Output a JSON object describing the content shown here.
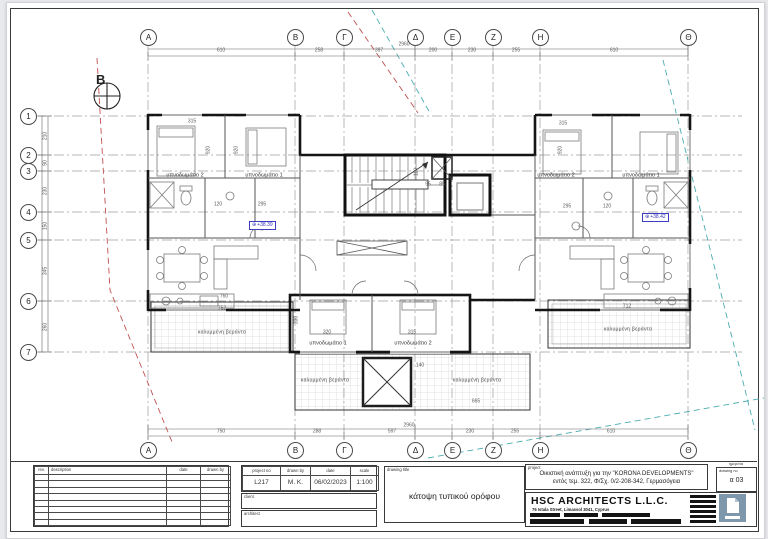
{
  "north_label": "B",
  "grid": {
    "top_letters": [
      "A",
      "B",
      "Γ",
      "Δ",
      "E",
      "Z",
      "H",
      "Θ"
    ],
    "bottom_letters": [
      "A",
      "B",
      "Γ",
      "Δ",
      "E",
      "Z",
      "H",
      "Θ"
    ],
    "left_numbers": [
      "1",
      "2",
      "3",
      "4",
      "5",
      "6",
      "7"
    ]
  },
  "plan": {
    "levels": {
      "icon": "⊕",
      "left": "+38.39",
      "right": "+38.42"
    },
    "annotations": [
      {
        "t": "610",
        "x": 221,
        "y": 51
      },
      {
        "t": "258",
        "x": 319,
        "y": 51
      },
      {
        "t": "397",
        "x": 379,
        "y": 51
      },
      {
        "t": "200",
        "x": 433,
        "y": 51
      },
      {
        "t": "230",
        "x": 472,
        "y": 51
      },
      {
        "t": "255",
        "x": 516,
        "y": 51
      },
      {
        "t": "610",
        "x": 614,
        "y": 51
      },
      {
        "t": "2960",
        "x": 404,
        "y": 45
      },
      {
        "t": "750",
        "x": 221,
        "y": 432
      },
      {
        "t": "288",
        "x": 317,
        "y": 432
      },
      {
        "t": "597",
        "x": 392,
        "y": 432
      },
      {
        "t": "230",
        "x": 470,
        "y": 432
      },
      {
        "t": "255",
        "x": 515,
        "y": 432
      },
      {
        "t": "610",
        "x": 611,
        "y": 432
      },
      {
        "t": "2960",
        "x": 409,
        "y": 426
      },
      {
        "t": "210",
        "x": 46,
        "y": 136,
        "r": -90
      },
      {
        "t": "90",
        "x": 46,
        "y": 163,
        "r": -90
      },
      {
        "t": "230",
        "x": 46,
        "y": 191,
        "r": -90
      },
      {
        "t": "150",
        "x": 46,
        "y": 226,
        "r": -90
      },
      {
        "t": "345",
        "x": 46,
        "y": 271,
        "r": -90
      },
      {
        "t": "260",
        "x": 46,
        "y": 327,
        "r": -90
      },
      {
        "t": "315",
        "x": 192,
        "y": 122
      },
      {
        "t": "315",
        "x": 563,
        "y": 124
      },
      {
        "t": "920",
        "x": 209,
        "y": 150,
        "r": -90
      },
      {
        "t": "920",
        "x": 237,
        "y": 150,
        "r": -90
      },
      {
        "t": "920",
        "x": 561,
        "y": 150,
        "r": -90
      },
      {
        "t": "120",
        "x": 218,
        "y": 205
      },
      {
        "t": "295",
        "x": 262,
        "y": 205
      },
      {
        "t": "295",
        "x": 567,
        "y": 207
      },
      {
        "t": "120",
        "x": 607,
        "y": 207
      },
      {
        "t": "110",
        "x": 417,
        "y": 172,
        "r": -90
      },
      {
        "t": "95",
        "x": 428,
        "y": 185
      },
      {
        "t": "85",
        "x": 442,
        "y": 185
      },
      {
        "t": "760",
        "x": 224,
        "y": 297
      },
      {
        "t": "752",
        "x": 222,
        "y": 309
      },
      {
        "t": "712",
        "x": 627,
        "y": 307
      },
      {
        "t": "320",
        "x": 327,
        "y": 333
      },
      {
        "t": "315",
        "x": 412,
        "y": 333
      },
      {
        "t": "330",
        "x": 297,
        "y": 320,
        "r": -90
      },
      {
        "t": "140",
        "x": 420,
        "y": 366
      },
      {
        "t": "665",
        "x": 476,
        "y": 402
      },
      {
        "t": "υπνοδωμάτιο 2",
        "x": 185,
        "y": 176,
        "c": "room"
      },
      {
        "t": "υπνοδωμάτιο 1",
        "x": 264,
        "y": 176,
        "c": "room"
      },
      {
        "t": "υπνοδωμάτιο 2",
        "x": 556,
        "y": 176,
        "c": "room"
      },
      {
        "t": "υπνοδωμάτιο 1",
        "x": 641,
        "y": 176,
        "c": "room"
      },
      {
        "t": "υπνοδωμάτιο 1",
        "x": 328,
        "y": 344,
        "c": "room"
      },
      {
        "t": "υπνοδωμάτιο 2",
        "x": 413,
        "y": 344,
        "c": "room"
      },
      {
        "t": "καλυμμένη βεράντα",
        "x": 222,
        "y": 333,
        "c": "ver"
      },
      {
        "t": "καλυμμένη βεράντα",
        "x": 628,
        "y": 330,
        "c": "ver"
      },
      {
        "t": "καλυμμένη βεράντα",
        "x": 325,
        "y": 381,
        "c": "ver"
      },
      {
        "t": "καλυμμένη βεράντα",
        "x": 477,
        "y": 381,
        "c": "ver"
      }
    ]
  },
  "titleblock": {
    "revision_table": {
      "headers": [
        "rev.",
        "description",
        "date",
        "drawn by"
      ]
    },
    "project_info": {
      "headers": [
        "project no",
        "drawn by",
        "date",
        "scale"
      ],
      "values": [
        "L217",
        "M. K.",
        "06/02/2023",
        "1:100"
      ]
    },
    "client_label": "client",
    "architect_label": "architect",
    "drawing_title_label": "drawing title",
    "drawing_title": "κάτοψη τυπικού ορόφου",
    "project_label": "project",
    "project_line1": "Οικιστική ανάπτυξη για την \"KORONA DEVELOPMENTS\"",
    "project_line2": "εντός τεμ. 322, Φ/Σχ. 0/2-208-342, Γερμασόγεια",
    "corner_label": "ημερ/νία",
    "drawing_no_label": "drawing no",
    "drawing_no": "α 03",
    "firm_name": "HSC ARCHITECTS L.L.C.",
    "firm_address": "76 Istala Street, Limassol 3041, Cyprus",
    "accent_colors": {
      "level_marker_blue": "#3d3dc0",
      "logo_slate": "#7e97ab"
    }
  }
}
